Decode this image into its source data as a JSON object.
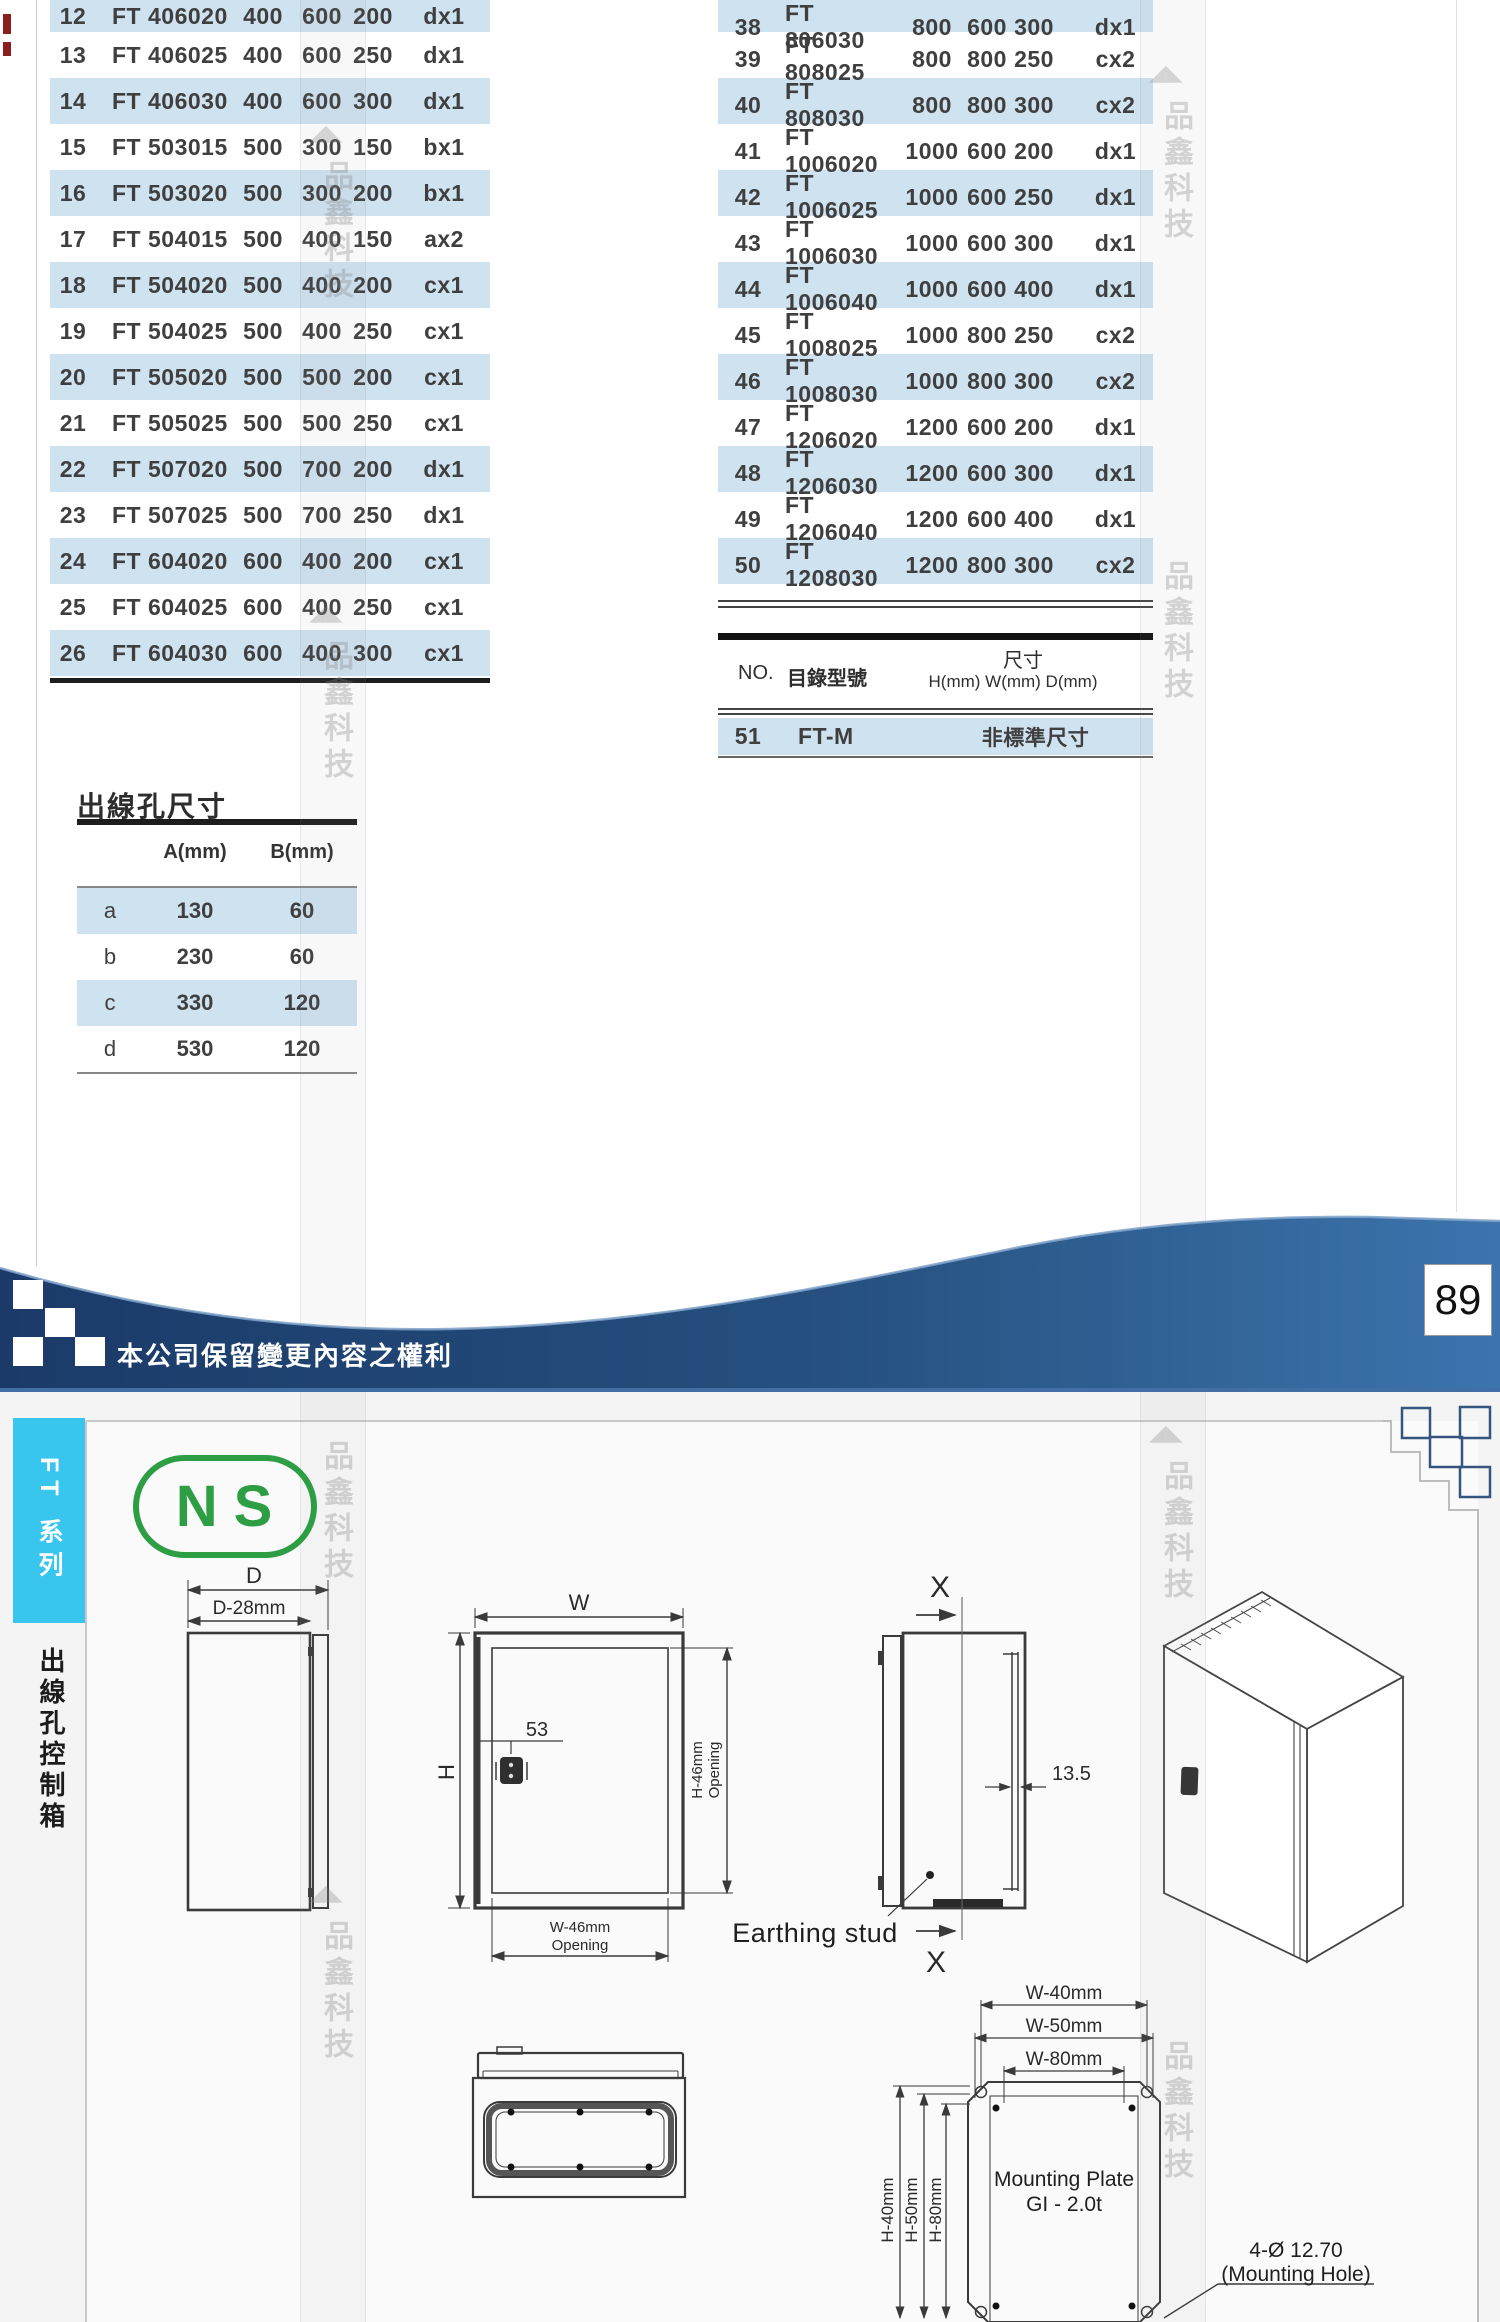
{
  "catalog": {
    "left_rows": [
      {
        "no": "12",
        "model": "FT 406020",
        "h": "400",
        "w": "600",
        "d": "200",
        "code": "dx1"
      },
      {
        "no": "13",
        "model": "FT 406025",
        "h": "400",
        "w": "600",
        "d": "250",
        "code": "dx1"
      },
      {
        "no": "14",
        "model": "FT 406030",
        "h": "400",
        "w": "600",
        "d": "300",
        "code": "dx1"
      },
      {
        "no": "15",
        "model": "FT 503015",
        "h": "500",
        "w": "300",
        "d": "150",
        "code": "bx1"
      },
      {
        "no": "16",
        "model": "FT 503020",
        "h": "500",
        "w": "300",
        "d": "200",
        "code": "bx1"
      },
      {
        "no": "17",
        "model": "FT 504015",
        "h": "500",
        "w": "400",
        "d": "150",
        "code": "ax2"
      },
      {
        "no": "18",
        "model": "FT 504020",
        "h": "500",
        "w": "400",
        "d": "200",
        "code": "cx1"
      },
      {
        "no": "19",
        "model": "FT 504025",
        "h": "500",
        "w": "400",
        "d": "250",
        "code": "cx1"
      },
      {
        "no": "20",
        "model": "FT 505020",
        "h": "500",
        "w": "500",
        "d": "200",
        "code": "cx1"
      },
      {
        "no": "21",
        "model": "FT 505025",
        "h": "500",
        "w": "500",
        "d": "250",
        "code": "cx1"
      },
      {
        "no": "22",
        "model": "FT 507020",
        "h": "500",
        "w": "700",
        "d": "200",
        "code": "dx1"
      },
      {
        "no": "23",
        "model": "FT 507025",
        "h": "500",
        "w": "700",
        "d": "250",
        "code": "dx1"
      },
      {
        "no": "24",
        "model": "FT 604020",
        "h": "600",
        "w": "400",
        "d": "200",
        "code": "cx1"
      },
      {
        "no": "25",
        "model": "FT 604025",
        "h": "600",
        "w": "400",
        "d": "250",
        "code": "cx1"
      },
      {
        "no": "26",
        "model": "FT 604030",
        "h": "600",
        "w": "400",
        "d": "300",
        "code": "cx1"
      }
    ],
    "right_rows": [
      {
        "no": "38",
        "model": "FT 806030",
        "h": "800",
        "w": "600",
        "d": "300",
        "code": "dx1"
      },
      {
        "no": "39",
        "model": "FT 808025",
        "h": "800",
        "w": "800",
        "d": "250",
        "code": "cx2"
      },
      {
        "no": "40",
        "model": "FT 808030",
        "h": "800",
        "w": "800",
        "d": "300",
        "code": "cx2"
      },
      {
        "no": "41",
        "model": "FT 1006020",
        "h": "1000",
        "w": "600",
        "d": "200",
        "code": "dx1"
      },
      {
        "no": "42",
        "model": "FT 1006025",
        "h": "1000",
        "w": "600",
        "d": "250",
        "code": "dx1"
      },
      {
        "no": "43",
        "model": "FT 1006030",
        "h": "1000",
        "w": "600",
        "d": "300",
        "code": "dx1"
      },
      {
        "no": "44",
        "model": "FT 1006040",
        "h": "1000",
        "w": "600",
        "d": "400",
        "code": "dx1"
      },
      {
        "no": "45",
        "model": "FT 1008025",
        "h": "1000",
        "w": "800",
        "d": "250",
        "code": "cx2"
      },
      {
        "no": "46",
        "model": "FT 1008030",
        "h": "1000",
        "w": "800",
        "d": "300",
        "code": "cx2"
      },
      {
        "no": "47",
        "model": "FT 1206020",
        "h": "1200",
        "w": "600",
        "d": "200",
        "code": "dx1"
      },
      {
        "no": "48",
        "model": "FT 1206030",
        "h": "1200",
        "w": "600",
        "d": "300",
        "code": "dx1"
      },
      {
        "no": "49",
        "model": "FT 1206040",
        "h": "1200",
        "w": "600",
        "d": "400",
        "code": "dx1"
      },
      {
        "no": "50",
        "model": "FT 1208030",
        "h": "1200",
        "w": "800",
        "d": "300",
        "code": "cx2"
      }
    ],
    "footer": {
      "no_label": "NO.",
      "model_label": "目錄型號",
      "size_label": "尺寸",
      "size_sub_label": "H(mm) W(mm) D(mm)"
    },
    "special": {
      "no": "51",
      "model": "FT-M",
      "size": "非標準尺寸"
    }
  },
  "hole_table": {
    "title": "出線孔尺寸",
    "headers": {
      "a": "A(mm)",
      "b": "B(mm)"
    },
    "rows": [
      {
        "key": "a",
        "a": "130",
        "b": "60"
      },
      {
        "key": "b",
        "a": "230",
        "b": "60"
      },
      {
        "key": "c",
        "a": "330",
        "b": "120"
      },
      {
        "key": "d",
        "a": "530",
        "b": "120"
      }
    ]
  },
  "banner": {
    "note": "本公司保留變更內容之權利",
    "page_number": "89"
  },
  "sidebar": {
    "series": "FT 系列",
    "category": "出線孔控制箱"
  },
  "logo": {
    "text": "NS"
  },
  "watermark": {
    "text": "品鑫科技",
    "triangle": "◣◢"
  },
  "drawings": {
    "side_view": {
      "dim_outer": "D",
      "dim_inner": "D-28mm"
    },
    "front_view": {
      "dim_w": "W",
      "dim_h": "H",
      "lock_offset": "53",
      "opening_h_line1": "H-46mm",
      "opening_h_line2": "Opening",
      "opening_w_line1": "W-46mm",
      "opening_w_line2": "Opening"
    },
    "section_view": {
      "marker_top": "X",
      "marker_bottom": "X",
      "flange_depth": "13.5",
      "earthing_label": "Earthing stud"
    },
    "mounting_plate": {
      "w_dim_1": "W-40mm",
      "w_dim_2": "W-50mm",
      "w_dim_3": "W-80mm",
      "h_dim_1": "H-40mm",
      "h_dim_2": "H-50mm",
      "h_dim_3": "H-80mm",
      "label_line1": "Mounting Plate",
      "label_line2": "GI - 2.0t",
      "hole_note_line1": "4-Ø 12.70",
      "hole_note_line2": "(Mounting Hole)"
    }
  },
  "colors": {
    "row_blue": "#cfe2f0",
    "banner_dark": "#1b3a69",
    "banner_light": "#3d74ad",
    "tab_cyan": "#38c5ee",
    "logo_green": "#2e9e45"
  }
}
